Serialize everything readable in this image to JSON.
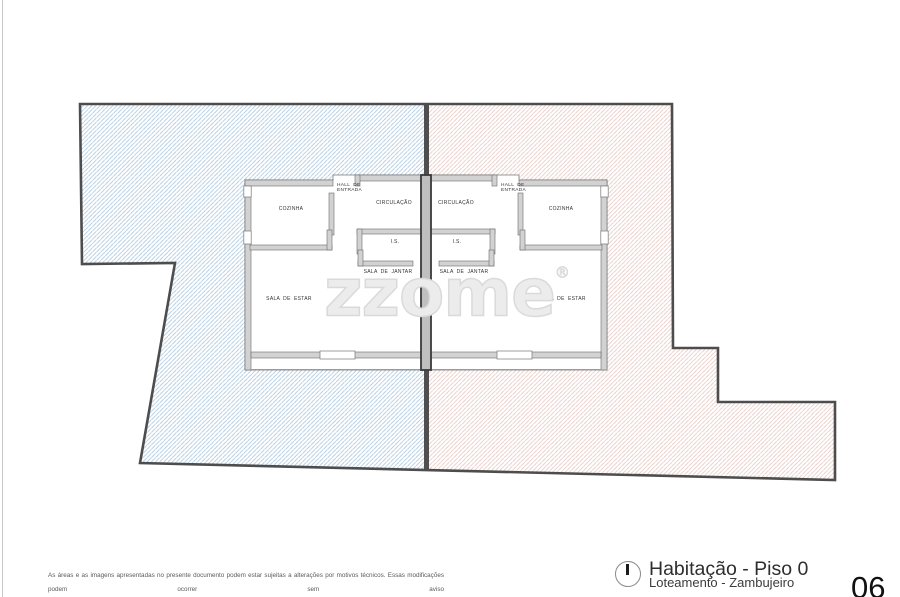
{
  "watermark": {
    "text": "zzome",
    "registered": "®"
  },
  "floor_plan": {
    "left_unit": {
      "cozinha": "COZINHA",
      "hall": "HALL DE\nENTRADA",
      "circulacao": "CIRCULAÇÃO",
      "is": "I.S.",
      "sala_de_jantar": "SALA DE JANTAR",
      "sala_de_estar": "SALA DE ESTAR"
    },
    "right_unit": {
      "cozinha": "COZINHA",
      "hall": "HALL DE\nENTRADA",
      "circulacao": "CIRCULAÇÃO",
      "is": "I.S.",
      "sala_de_jantar": "SALA DE JANTAR",
      "sala_de_estar": "SALA DE ESTAR"
    },
    "colors": {
      "hatch_left_lot": "#aecadf",
      "hatch_right_lot": "#e7cbc5",
      "lot_outline": "#4d4d4d",
      "wall_fill": "#d2d2d2"
    }
  },
  "disclaimer": {
    "line1": "As áreas e as imagens apresentadas no presente documento podem estar sujeitas a alterações por motivos técnicos. Essas modificações podem ocorrer sem aviso",
    "line2": "prévio. As representações visuais e descritivas fornecidas têm apenas propósitos ilustrativos e não devem ser consideradas como garantia ou compromisso vinculativo."
  },
  "title_block": {
    "icon": "north-indicator-icon",
    "title": "Habitação - Piso 0",
    "subtitle": "Loteamento - Zambujeiro",
    "sheet_number": "06"
  }
}
